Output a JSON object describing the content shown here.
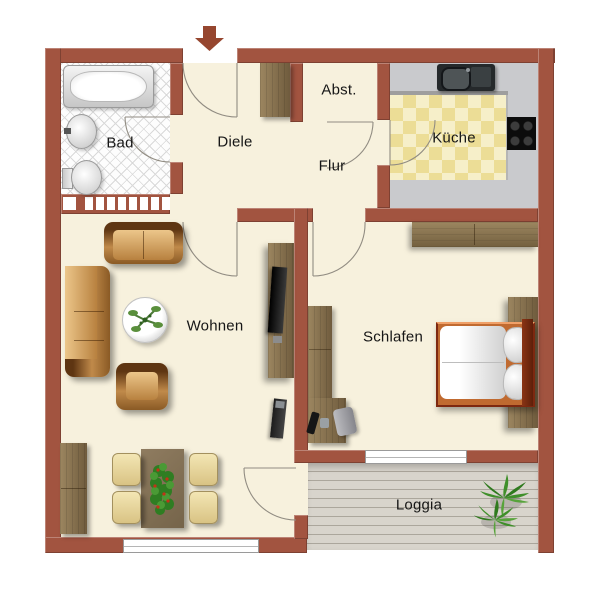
{
  "plan_title": "apartment-floor-plan",
  "rooms": {
    "bad": {
      "label": "Bad"
    },
    "diele": {
      "label": "Diele"
    },
    "abst": {
      "label": "Abst."
    },
    "flur": {
      "label": "Flur"
    },
    "kueche": {
      "label": "Küche"
    },
    "wohnen": {
      "label": "Wohnen"
    },
    "schlafen": {
      "label": "Schlafen"
    },
    "loggia": {
      "label": "Loggia"
    }
  },
  "entrance": {
    "icon": "down-arrow",
    "location": "top-wall"
  },
  "furniture": {
    "bad": [
      "bathtub",
      "washbasin",
      "toilet"
    ],
    "diele": [
      "wardrobe"
    ],
    "kueche": [
      "countertop",
      "sink",
      "stove"
    ],
    "wohnen": [
      "sofa-2-seat",
      "sofa-3-seat",
      "armchair",
      "coffee-table",
      "tv-sideboard",
      "stereo-rack",
      "dining-table",
      "dining-chairs",
      "sideboard"
    ],
    "schlafen": [
      "wardrobe",
      "double-bed",
      "bedside-cabinet",
      "desk",
      "desk-chair"
    ],
    "loggia": [
      "potted-plant"
    ]
  },
  "colors": {
    "wall": "#a25440",
    "floor": "#f7f1dd",
    "bad_tile_line": "#d9d9d9",
    "kitchen_counter": "#c9cacd",
    "kitchen_tile_light": "#f6efc9",
    "kitchen_tile_dark": "#ecdd96",
    "deck": "#d8d4cc",
    "wood": "#8a7352",
    "leather": "#c08a4a",
    "bed_frame": "#c06a30",
    "label_text": "#161616",
    "door_arc": "#918c82"
  }
}
